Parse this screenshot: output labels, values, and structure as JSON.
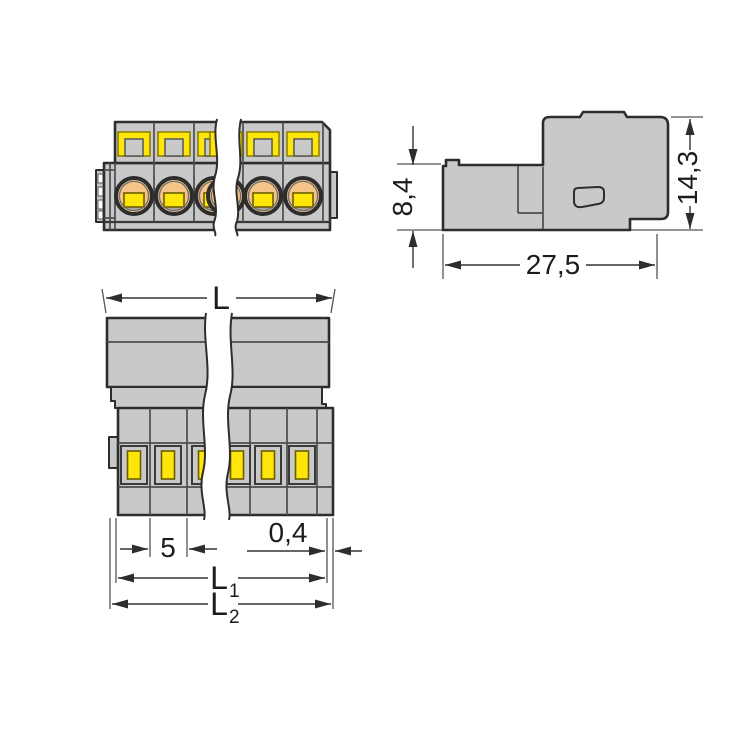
{
  "drawing": {
    "kind": "connector dimensional drawing",
    "colors": {
      "background": "#ffffff",
      "body_gray": "#c9c9c9",
      "outline": "#2d2d2d",
      "contact_yellow": "#ffe60a",
      "clamp_orange": "#f6c489",
      "dim_line": "#333333"
    },
    "views": {
      "front": "front view with clamping units",
      "side": "side profile view",
      "top": "top view with pin slots"
    },
    "dimensions": {
      "front_height": "8,4",
      "total_height": "14,3",
      "depth": "27,5",
      "overall_length": "L",
      "pole_pitch": "5",
      "end_offset": "0,4",
      "l1": {
        "base": "L",
        "sub": "1"
      },
      "l2": {
        "base": "L",
        "sub": "2"
      }
    }
  }
}
